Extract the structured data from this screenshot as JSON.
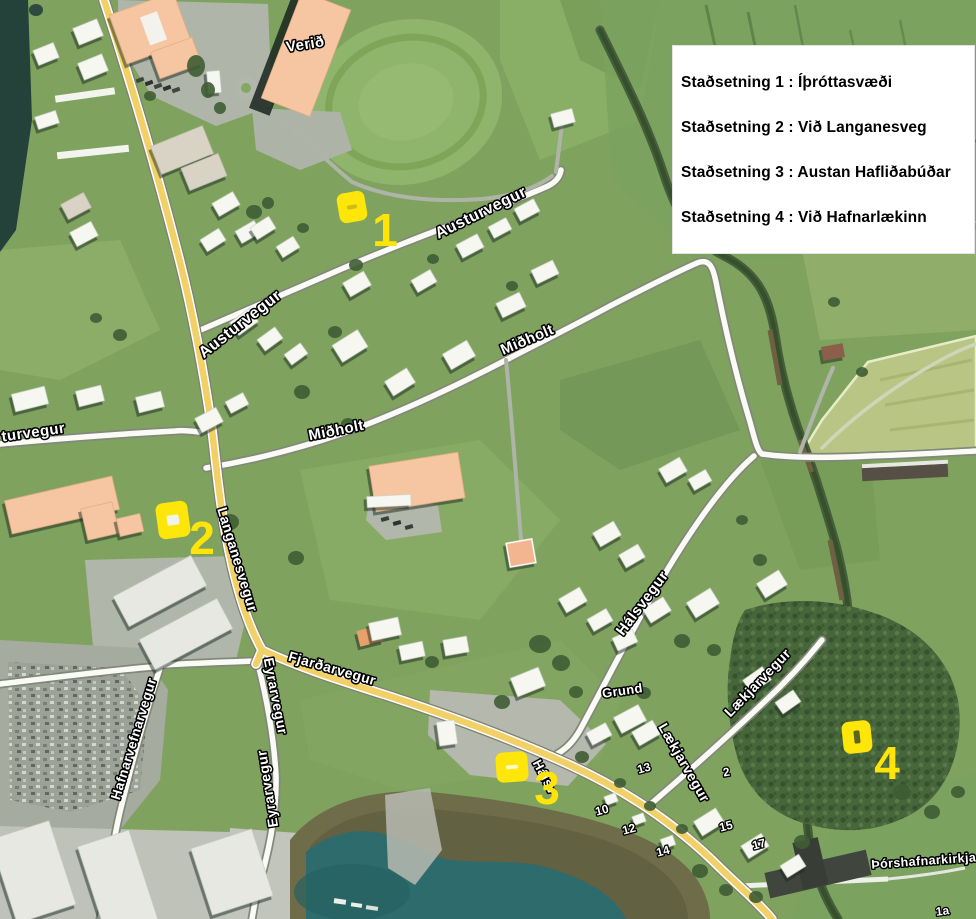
{
  "legend": {
    "items": [
      "Staðsetning 1 : Íþróttasvæði",
      "Staðsetning 2 : Við Langanesveg",
      "Staðsetning 3 : Austan Hafliðabúðar",
      "Staðsetning 4 : Við Hafnarlækinn"
    ]
  },
  "markers": [
    {
      "num": "1",
      "cx": 352,
      "cy": 207,
      "w": 28,
      "h": 30,
      "rot": -10,
      "inner": {
        "w": 10,
        "h": 4,
        "fill": "#cdbd1a"
      },
      "label_x": 385,
      "label_y": 246
    },
    {
      "num": "2",
      "cx": 173,
      "cy": 520,
      "w": 32,
      "h": 36,
      "rot": -8,
      "inner": {
        "w": 12,
        "h": 10,
        "fill": "#f2f3ea"
      },
      "label_x": 202,
      "label_y": 554
    },
    {
      "num": "3",
      "cx": 512,
      "cy": 767,
      "w": 32,
      "h": 30,
      "rot": -4,
      "inner": {
        "w": 12,
        "h": 4,
        "fill": "#fff9c4"
      },
      "label_x": 547,
      "label_y": 804
    },
    {
      "num": "4",
      "cx": 857,
      "cy": 737,
      "w": 29,
      "h": 32,
      "rot": -6,
      "inner": {
        "w": 6,
        "h": 13,
        "fill": "#5c6520"
      },
      "label_x": 887,
      "label_y": 779
    }
  ],
  "street_labels": [
    {
      "text": "Verið",
      "x": 306,
      "y": 49,
      "rot": -9,
      "size": 15
    },
    {
      "text": "Austurvegur",
      "x": 483,
      "y": 217,
      "rot": -26,
      "size": 16
    },
    {
      "text": "Austurvegur",
      "x": 243,
      "y": 328,
      "rot": -38,
      "size": 16
    },
    {
      "text": "turvegur",
      "x": 34,
      "y": 437,
      "rot": -8,
      "size": 15
    },
    {
      "text": "Miðholt",
      "x": 529,
      "y": 344,
      "rot": -23,
      "size": 15
    },
    {
      "text": "Miðholt",
      "x": 337,
      "y": 435,
      "rot": -11,
      "size": 15
    },
    {
      "text": "Langanesvegur",
      "x": 233,
      "y": 561,
      "rot": 73,
      "size": 14
    },
    {
      "text": "Fjarðarvegur",
      "x": 331,
      "y": 673,
      "rot": 16,
      "size": 14
    },
    {
      "text": "Eyrarvegur",
      "x": 271,
      "y": 697,
      "rot": 79,
      "size": 14
    },
    {
      "text": "Eyrarvegur",
      "x": 272,
      "y": 788,
      "rot": -99,
      "size": 14
    },
    {
      "text": "Hafnarvefnarvegur",
      "x": 138,
      "y": 740,
      "rot": -73,
      "size": 13.5
    },
    {
      "text": "Hálsvegur",
      "x": 646,
      "y": 606,
      "rot": -53,
      "size": 15
    },
    {
      "text": "Hálsv",
      "x": 541,
      "y": 779,
      "rot": 62,
      "size": 13
    },
    {
      "text": "Lækjarvegur",
      "x": 761,
      "y": 686,
      "rot": -46,
      "size": 14
    },
    {
      "text": "Lækjarvegur",
      "x": 680,
      "y": 765,
      "rot": 60,
      "size": 14
    },
    {
      "text": "Grund",
      "x": 623,
      "y": 695,
      "rot": -8,
      "size": 13
    },
    {
      "text": "Þórshafnarkirkja",
      "x": 924,
      "y": 865,
      "rot": -4,
      "size": 12.5
    }
  ],
  "house_numbers": [
    {
      "text": "13",
      "x": 645,
      "y": 772,
      "rot": -15
    },
    {
      "text": "10",
      "x": 603,
      "y": 814,
      "rot": -15
    },
    {
      "text": "12",
      "x": 630,
      "y": 833,
      "rot": -15
    },
    {
      "text": "14",
      "x": 664,
      "y": 855,
      "rot": -15
    },
    {
      "text": "15",
      "x": 727,
      "y": 830,
      "rot": -15
    },
    {
      "text": "17",
      "x": 760,
      "y": 848,
      "rot": -15
    },
    {
      "text": "2",
      "x": 727,
      "y": 776,
      "rot": -10
    },
    {
      "text": "1a",
      "x": 943,
      "y": 915,
      "rot": -8
    }
  ],
  "colors": {
    "marker_yellow": "#ffe60a",
    "number_yellow": "#ffe40a",
    "label_fill": "#ffffff",
    "label_stroke": "#000000",
    "legend_bg": "#ffffff",
    "water": "#2e6b6c",
    "main_road": "#f1d167"
  }
}
